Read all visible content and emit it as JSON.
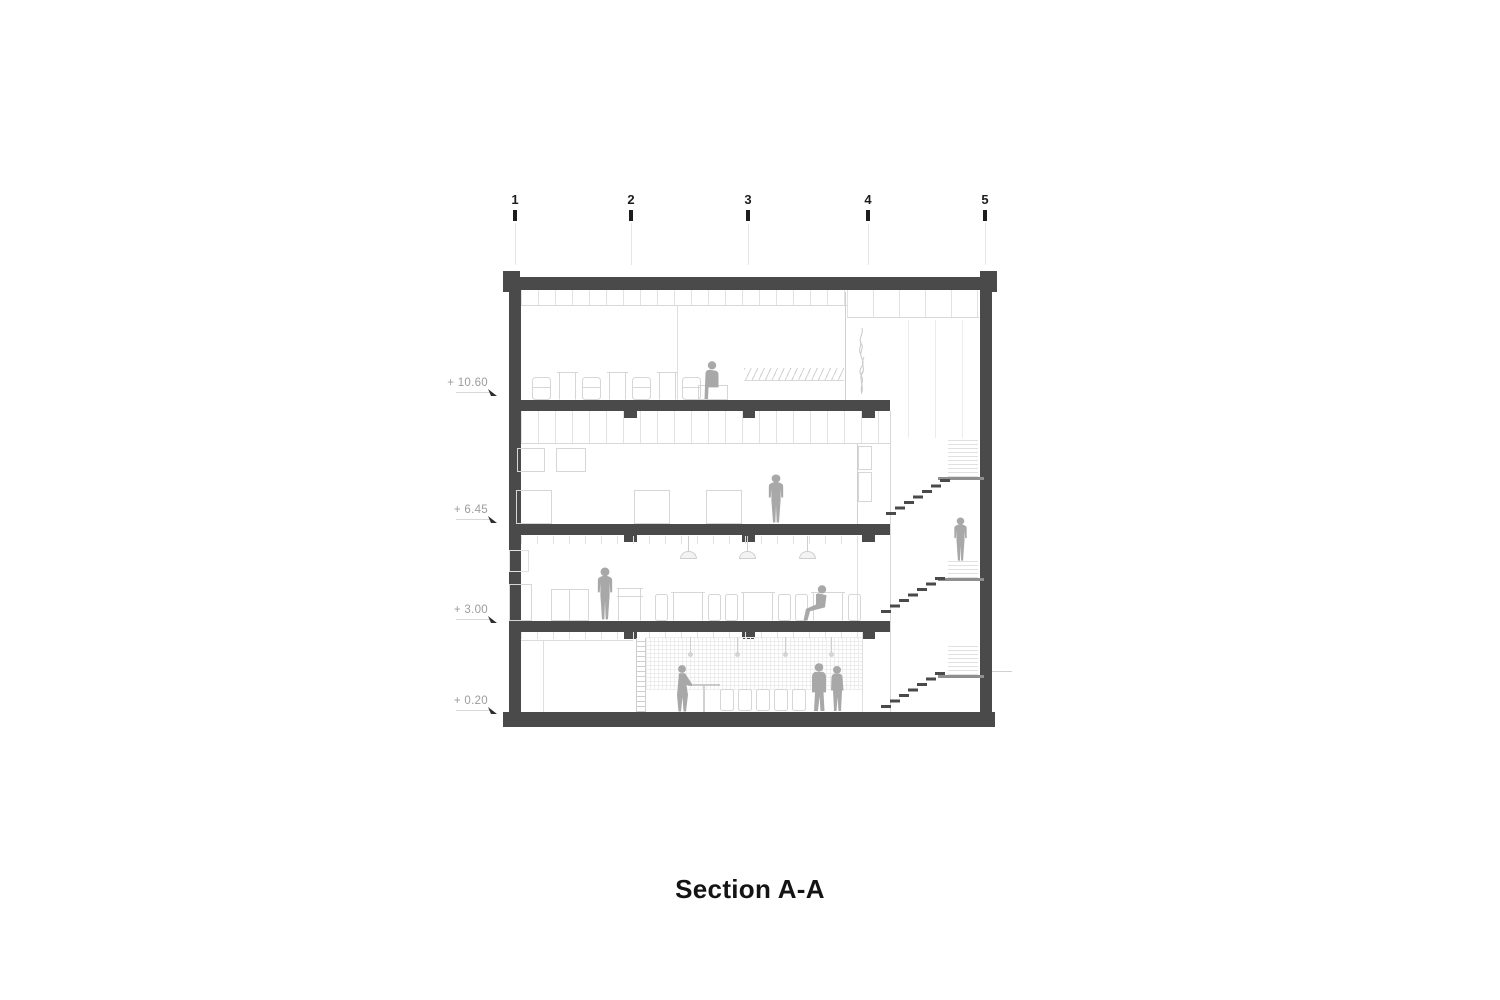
{
  "drawing": {
    "title": "Section A-A",
    "grid_markers": {
      "labels": [
        "1",
        "2",
        "3",
        "4",
        "5"
      ]
    },
    "level_markers": {
      "labels": [
        "+ 10.60",
        "+ 6.45",
        "+ 3.00",
        "+ 0.20"
      ]
    },
    "colors": {
      "structure": "#4a4a4a",
      "figure": "#a8a8a8",
      "furniture": "#d6d6d6",
      "faint": "#e2e2e2",
      "label_text": "#9c9c9c",
      "grid_text": "#1d1d1d",
      "landing": "#8f8f8f",
      "background": "#ffffff"
    }
  }
}
